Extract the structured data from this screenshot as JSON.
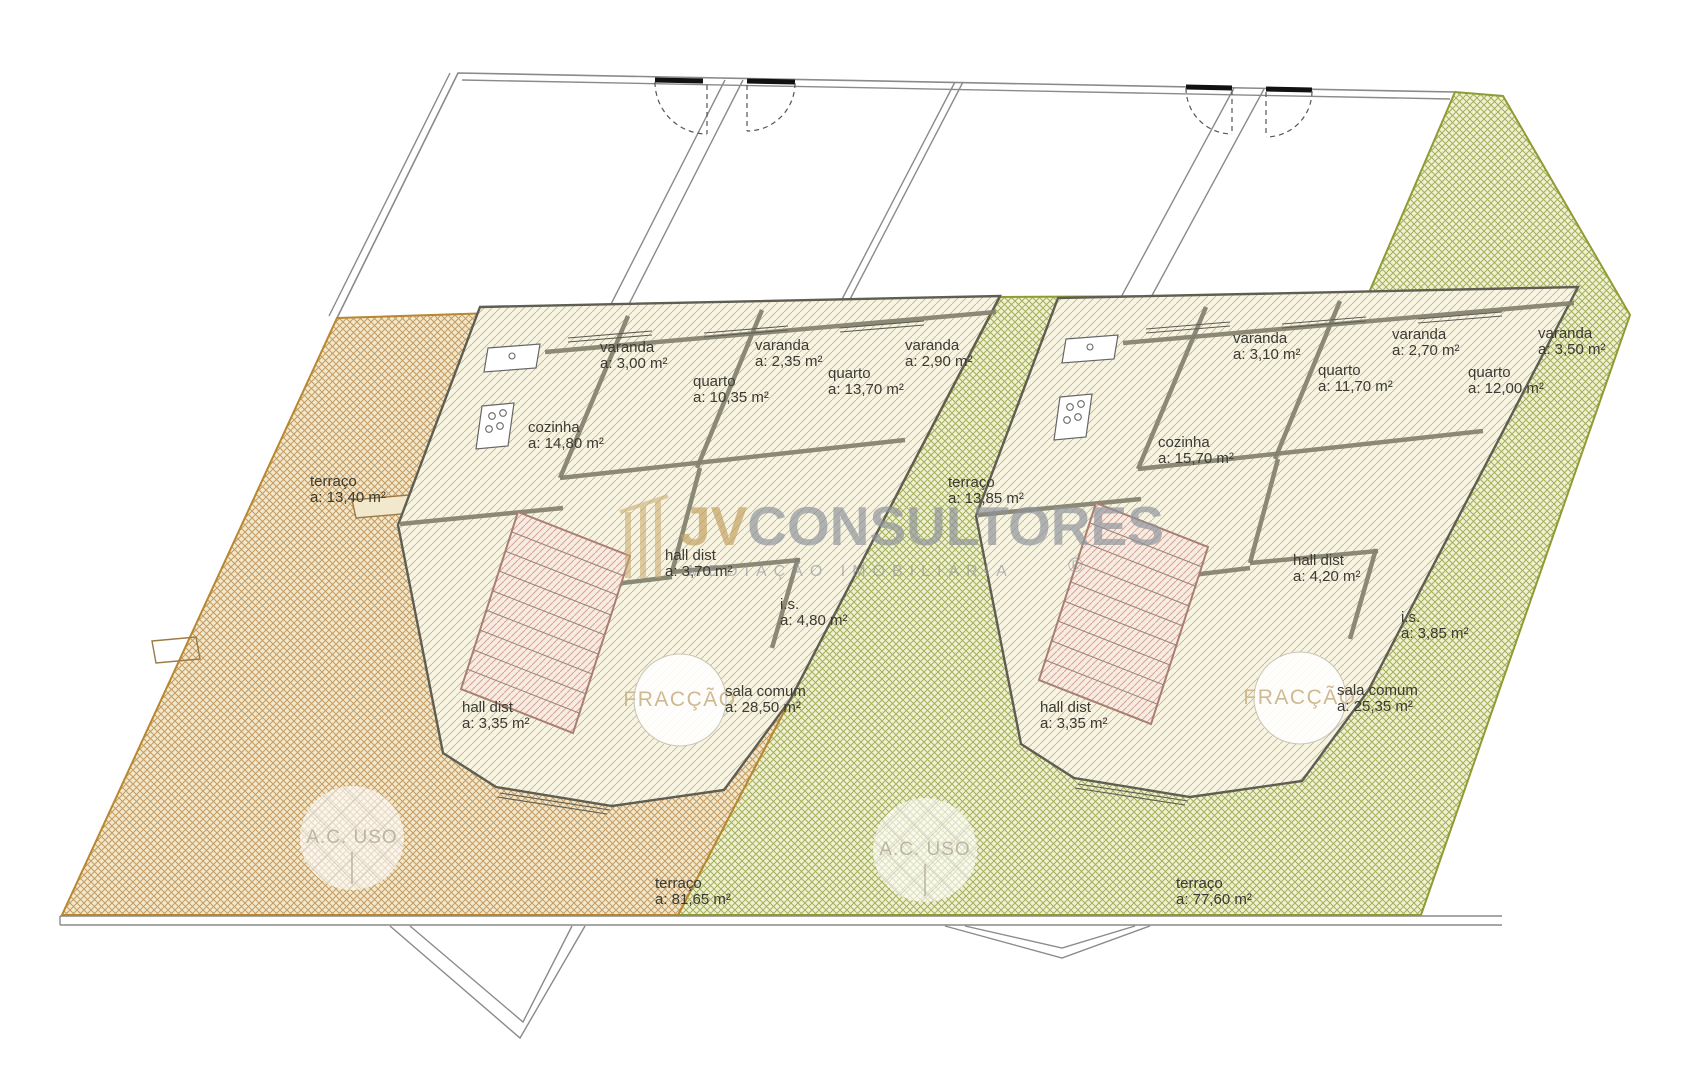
{
  "watermark": {
    "logo_prefix": "JV",
    "logo_suffix": "CONSULTORES",
    "tagline": "MEDIAÇÃO IMOBILIÁRIA",
    "registered_mark": "®",
    "logo_prefix_color": "#c3a060",
    "logo_suffix_color": "#8f949c"
  },
  "stamps": {
    "fraction": "FRACÇÃO",
    "common_use": "A.C. USO"
  },
  "labels": {
    "area_prefix": "a:"
  },
  "colors": {
    "terrace_left_hatch": "#c49a62",
    "terrace_left_bg": "#f2e8cb",
    "terrace_left_border": "#b8872f",
    "terrace_right_hatch": "#a4ae58",
    "terrace_right_bg": "#eff1d3",
    "terrace_right_border": "#8f9c33",
    "apartment_hatch": "#beb89e",
    "apartment_bg": "#f8f4e2",
    "stair_hatch": "#d7a296",
    "stair_bg": "#f7ece2",
    "outline": "#8a8a8a",
    "label_text": "#3b3a33"
  },
  "rooms": {
    "left": [
      {
        "name": "varanda",
        "area": "3,00 m²",
        "x": 600,
        "y": 352
      },
      {
        "name": "varanda",
        "area": "2,35 m²",
        "x": 755,
        "y": 350
      },
      {
        "name": "varanda",
        "area": "2,90 m²",
        "x": 905,
        "y": 350
      },
      {
        "name": "quarto",
        "area": "10,35 m²",
        "x": 693,
        "y": 386
      },
      {
        "name": "quarto",
        "area": "13,70 m²",
        "x": 828,
        "y": 378
      },
      {
        "name": "cozinha",
        "area": "14,80 m²",
        "x": 528,
        "y": 432
      },
      {
        "name": "terraço",
        "area": "13,40 m²",
        "x": 310,
        "y": 486
      },
      {
        "name": "hall dist",
        "area": "3,70 m²",
        "x": 665,
        "y": 560
      },
      {
        "name": "i.s.",
        "area": "4,80 m²",
        "x": 780,
        "y": 609
      },
      {
        "name": "sala comum",
        "area": "28,50 m²",
        "x": 725,
        "y": 696
      },
      {
        "name": "hall dist",
        "area": "3,35 m²",
        "x": 462,
        "y": 712
      },
      {
        "name": "terraço",
        "area": "81,65 m²",
        "x": 655,
        "y": 888
      }
    ],
    "right": [
      {
        "name": "varanda",
        "area": "3,10 m²",
        "x": 1233,
        "y": 343
      },
      {
        "name": "varanda",
        "area": "2,70 m²",
        "x": 1392,
        "y": 339
      },
      {
        "name": "varanda",
        "area": "3,50 m²",
        "x": 1538,
        "y": 338
      },
      {
        "name": "quarto",
        "area": "11,70 m²",
        "x": 1318,
        "y": 375
      },
      {
        "name": "quarto",
        "area": "12,00 m²",
        "x": 1468,
        "y": 377
      },
      {
        "name": "cozinha",
        "area": "15,70 m²",
        "x": 1158,
        "y": 447
      },
      {
        "name": "terraço",
        "area": "13,85 m²",
        "x": 948,
        "y": 487
      },
      {
        "name": "hall dist",
        "area": "4,20 m²",
        "x": 1293,
        "y": 565
      },
      {
        "name": "i.s.",
        "area": "3,85 m²",
        "x": 1401,
        "y": 622
      },
      {
        "name": "sala comum",
        "area": "25,35 m²",
        "x": 1337,
        "y": 695
      },
      {
        "name": "hall dist",
        "area": "3,35 m²",
        "x": 1040,
        "y": 712
      },
      {
        "name": "terraço",
        "area": "77,60 m²",
        "x": 1176,
        "y": 888
      }
    ]
  }
}
